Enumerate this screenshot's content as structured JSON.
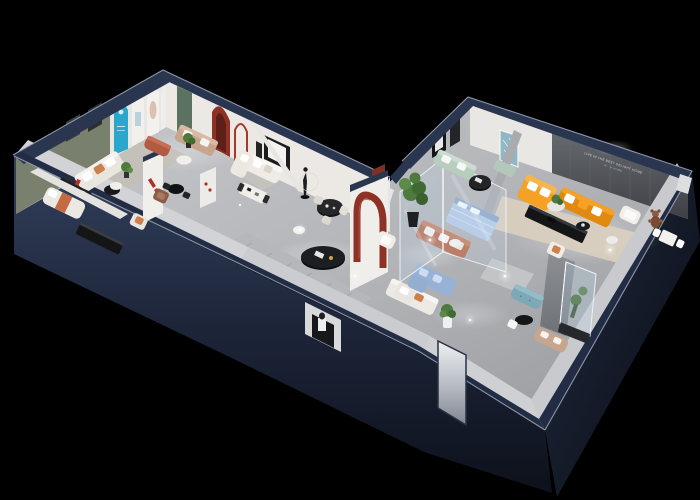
{
  "scene": {
    "title": "3D isometric cutaway floor plan render of a furniture showroom",
    "view": "dollhouse isometric cutaway, black background",
    "background": "#000000",
    "rooms": [
      "left gallery showroom with arched display wall",
      "bedroom display room",
      "living room display with sectional and dining table",
      "dining corner with black round table",
      "central corridor with runner rug",
      "glass-walled display room with blue furniture",
      "mint sofa lounge",
      "main showroom with orange sectional and slogan wall",
      "rest area with teal ottoman and glass plant case"
    ]
  },
  "palette": {
    "outer_wall_navy": "#2a3650",
    "outer_wall_edge": "#9aa3b4",
    "wall_white": "#ece9e5",
    "wall_sage": "#7a806e",
    "wall_slogan_gray": "#55585e",
    "floor_gray": "#b8babd",
    "arch_cyan": "#2ba7cb",
    "accent_red": "#8e3226",
    "door_green": "#5c7260",
    "sofa_orange": "#f5a126",
    "sofa_orange_deep": "#e08a0f",
    "sofa_terracotta": "#b96a4e",
    "sofa_tan": "#c8a68e",
    "sofa_mint": "#b9cdbf",
    "sofa_blue": "#b3c9e6",
    "sofa_blue_deep": "#98b2d6",
    "ottoman_teal": "#7da9b6",
    "media_black": "#141517",
    "plant_green": "#4e7a3d",
    "rug_beige": "#d9cfbf",
    "teal_art": "#8fb7c6",
    "maroon_cap": "#7e2f26"
  },
  "signage": {
    "wall_slogan_line1": "LIVE IN THE BEST DELIGHT HOME",
    "wall_slogan_line2": "N · M HOME"
  },
  "furniture": [
    "white sofa with orange pillows",
    "tan three-seat sofa",
    "terracotta ottoman",
    "round black side table",
    "white chaise with orange throw",
    "black media console",
    "wall shelf",
    "white armchair",
    "brown armchair",
    "white L-sectional",
    "white dining table",
    "mannequin sculpture",
    "black round dining table with cream chairs",
    "striped runner rug",
    "black oval coffee table",
    "terracotta sofa",
    "white L-sofa",
    "potted plants",
    "blue quilted bed",
    "blue sectional",
    "mint sofa",
    "mint bench",
    "black round coffee table",
    "orange L-sectional with white pillows",
    "black media console",
    "round plant table",
    "white armchair",
    "teddy bear figure",
    "white side tables",
    "white table and chairs set",
    "teal ottoman bench",
    "tan sofa",
    "glass plant display case",
    "doorway mirror",
    "entry niche with pedestal"
  ]
}
